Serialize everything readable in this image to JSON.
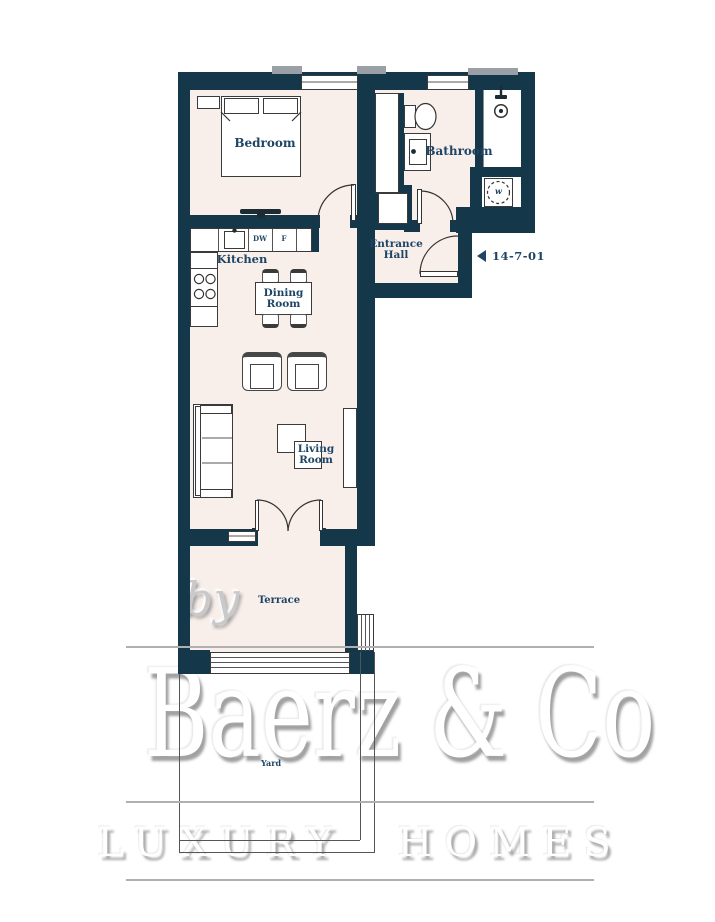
{
  "plan": {
    "rooms": {
      "bedroom": "Bedroom",
      "bathroom": "Bathroom",
      "kitchen": "Kitchen",
      "dining_line1": "Dining",
      "dining_line2": "Room",
      "entrance_line1": "Entrance",
      "entrance_line2": "Hall",
      "living_line1": "Living",
      "living_line2": "Room",
      "terrace": "Terrace",
      "yard": "Yard"
    },
    "appliances": {
      "dishwasher": "DW",
      "fridge": "F",
      "washer": "w"
    },
    "unit_number": "14-7-01"
  },
  "watermark": {
    "prefix": "by",
    "brand": "Baerz & Co",
    "tagline": "LUXURY HOMES"
  },
  "colors": {
    "wall": "#15374a",
    "floor": "#f8eeea",
    "label": "#1e4466",
    "plan_line": "#3a3a3a",
    "watermark_line": "#b0b0b0",
    "sill": "#9aa0a5"
  }
}
